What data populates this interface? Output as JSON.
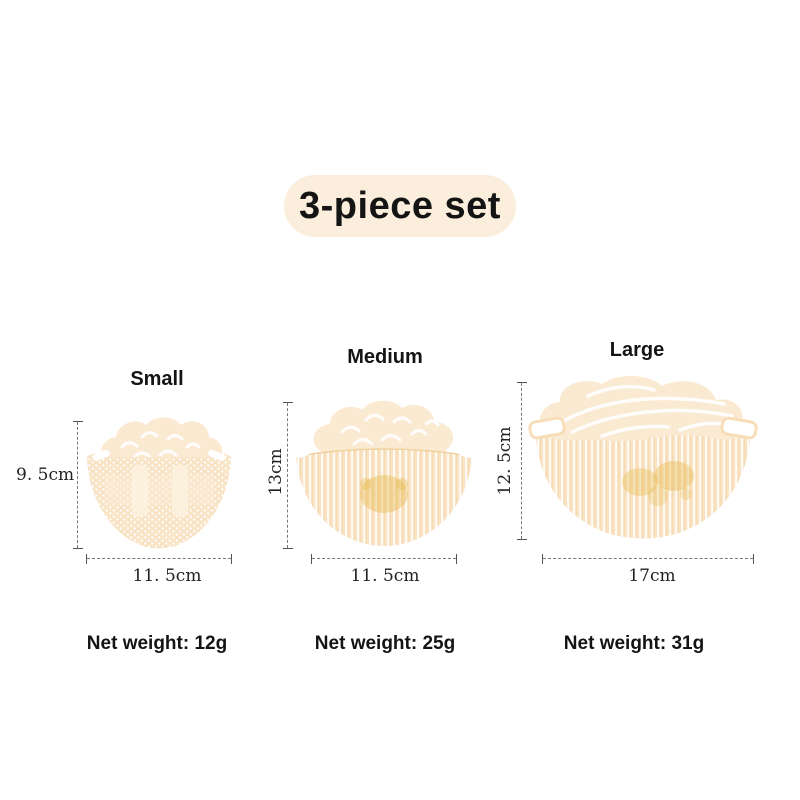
{
  "badge": {
    "label": "3-piece set",
    "bg_color": "#FBEEDC"
  },
  "products": [
    {
      "name": "Small",
      "height_dimension": "9. 5cm",
      "width_dimension": "11. 5cm",
      "net_weight": "Net weight: 12g"
    },
    {
      "name": "Medium",
      "height_dimension": "13cm",
      "width_dimension": "11. 5cm",
      "net_weight": "Net weight: 25g"
    },
    {
      "name": "Large",
      "height_dimension": "12. 5cm",
      "width_dimension": "17cm",
      "net_weight": "Net weight: 31g"
    }
  ],
  "colors": {
    "background": "#FFFFFF",
    "badge_bg": "#FBEEDC",
    "heading_text": "#141414",
    "dimension_text": "#222222",
    "dimension_line": "#777777",
    "product_cream": "#F8E3C5",
    "product_cream_light": "#FBEAD2",
    "product_gold_accent": "#E9BD55",
    "product_rim_outline": "#EECB8E"
  }
}
